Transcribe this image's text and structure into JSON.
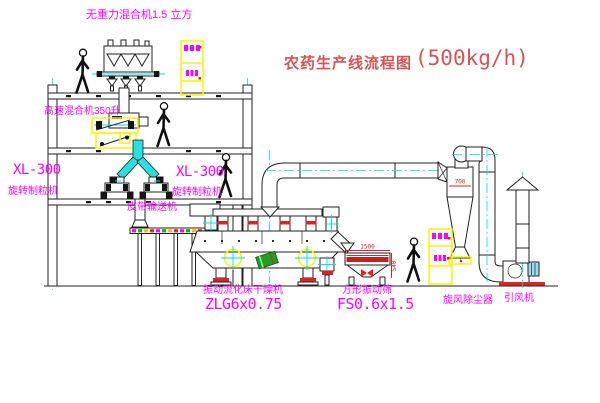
{
  "title": {
    "text_cn": "农药生产线流程图",
    "capacity": "(500kg/h)"
  },
  "labels": {
    "gravity_free_mixer": "无重力混合机1.5 立方",
    "high_speed_mixer": "高速混合机350升",
    "granulator_model": "XL-300",
    "granulator_name": "旋转制粒机",
    "belt_conveyor": "皮带输送机",
    "dryer_name": "振动流化床干燥机",
    "dryer_model": "ZLG6x0.75",
    "screen_name": "方形振动筛",
    "screen_model": "FS0.6x1.5",
    "cyclone": "旋风除尘器",
    "fan": "引风机"
  },
  "dimensions": {
    "screen_length": "1500",
    "screen_height": "540",
    "cyclone_width": "700"
  },
  "colors": {
    "label_magenta": "#ff00ff",
    "title_red": "#d95353",
    "centerline_cyan": "#00dede",
    "machine_yellow": "#f5f500",
    "dimension_red": "#e22222",
    "line_black": "#222222",
    "green_part": "#1fa01f"
  }
}
